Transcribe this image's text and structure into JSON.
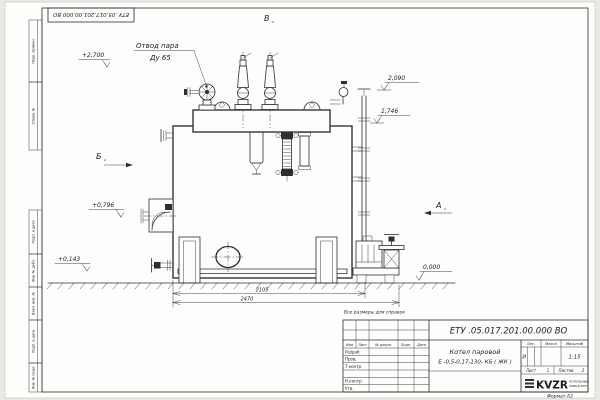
{
  "stamp": {
    "designation": "ЕТУ .05.017.201.00.000 ВО"
  },
  "note": "Все размеры для справок",
  "format_label": "Формат А3",
  "margin_labels": [
    "Перв. примен.",
    "Справ. №",
    "Подп. и дата",
    "Инв. № дубл.",
    "Взам. инв. №",
    "Подп. и дата",
    "Инв. № подл."
  ],
  "callout": {
    "line1": "Отвод пара",
    "line2": "Ду 65"
  },
  "views": {
    "top": "В",
    "left": "Б",
    "right": "А",
    "sheet_ref": "2"
  },
  "levels": {
    "v2700": "+2,700",
    "v2090": "2,090",
    "v1746": "1,746",
    "v0796": "+0,796",
    "v0143": "+0,143",
    "v0000": "0,000"
  },
  "dims": {
    "inner": "2105",
    "overall": "2470"
  },
  "title_block": {
    "designation": "ЕТУ .05.017.201.00.000 ВО",
    "name_line1": "Котел паровой",
    "name_line2": "Е -0,5-0,17-130- КБ ( ЖК )",
    "cols": {
      "izm": "Изм",
      "list": "Лист",
      "doc": "№ докум.",
      "podp": "Подп.",
      "date": "Дата"
    },
    "rows": {
      "razrab": "Разраб.",
      "prov": "Пров.",
      "tkontr": "Т.контр.",
      "nkontr": "Н.контр.",
      "utv": "Утв."
    },
    "lit_label": "Лит.",
    "mass_label": "Масса",
    "scale_label": "Масштаб",
    "lit": "И",
    "scale": "1:15",
    "sheet_label": "Лист",
    "sheet": "1",
    "sheets_label": "Листов",
    "sheets": "2",
    "logo": "KVZR",
    "logo_line1": "КОТЕЛЬНЫЙ",
    "logo_line2": "ЗАВОД РЭП"
  }
}
